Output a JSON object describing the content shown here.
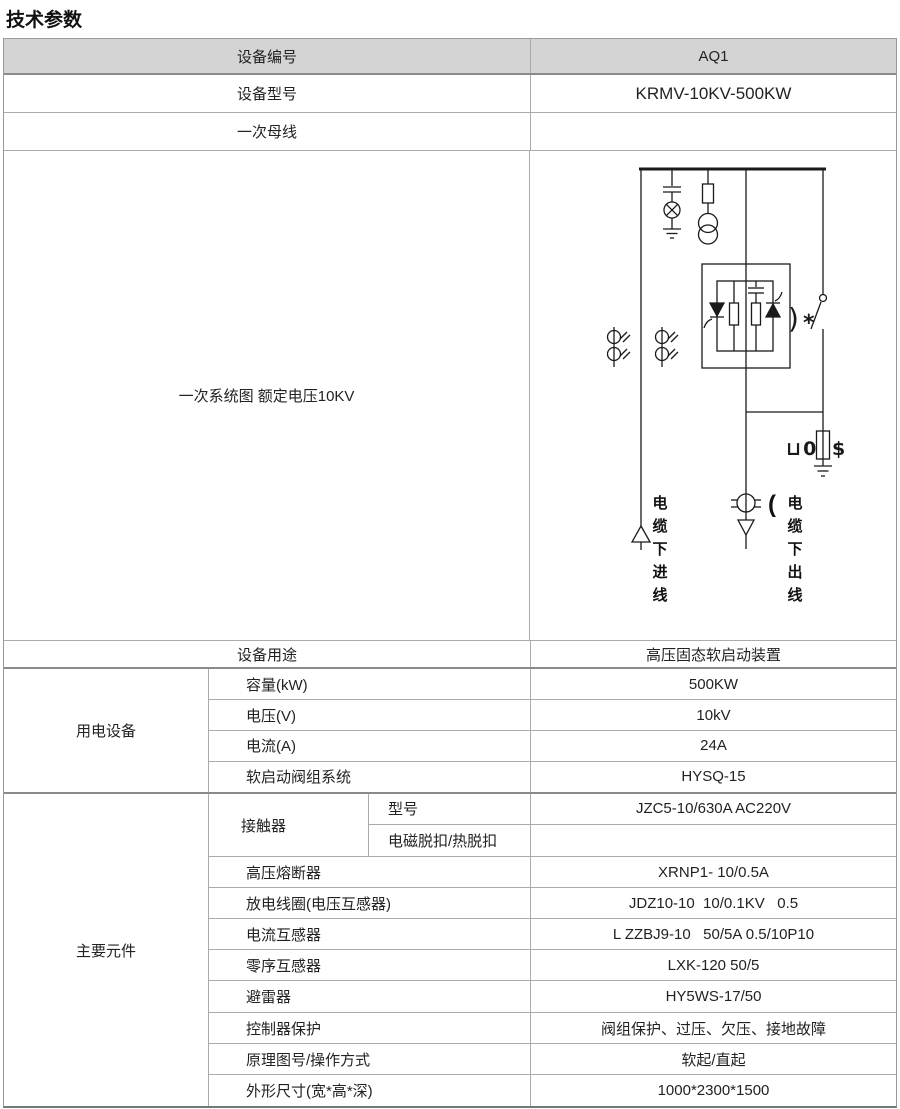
{
  "title": "技术参数",
  "header": {
    "label": "设备编号",
    "value": "AQ1"
  },
  "info_rows": [
    {
      "label": "设备型号",
      "value": "KRMV-10KV-500KW"
    },
    {
      "label": "一次母线",
      "value": ""
    }
  ],
  "diagram_row": {
    "label": "一次系统图 额定电压10KV",
    "incoming_cable": "电缆下进线",
    "outgoing_prefix": "(",
    "outgoing_cable": "电缆下出线",
    "switch_paren": ")",
    "switch_star": "*",
    "arrester_left": "⊔0",
    "arrester_right": "$"
  },
  "purpose_row": {
    "label": "设备用途",
    "value": "高压固态软启动装置"
  },
  "power_group": {
    "label": "用电设备",
    "rows": [
      {
        "label": "容量(kW)",
        "value": "500KW"
      },
      {
        "label": "电压(V)",
        "value": "10kV"
      },
      {
        "label": "电流(A)",
        "value": "24A"
      },
      {
        "label": "软启动阀组系统",
        "value": "HYSQ-15"
      }
    ]
  },
  "components_group": {
    "label": "主要元件",
    "contactor": {
      "label": "接触器",
      "rows": [
        {
          "label": "型号",
          "value": "JZC5-10/630A AC220V"
        },
        {
          "label": "电磁脱扣/热脱扣",
          "value": ""
        }
      ]
    },
    "rows": [
      {
        "label": "高压熔断器",
        "value": "XRNP1- 10/0.5A"
      },
      {
        "label": "放电线圈(电压互感器)",
        "value": "JDZ10-10  10/0.1KV   0.5"
      },
      {
        "label": "电流互感器",
        "value": "L ZZBJ9-10   50/5A 0.5/10P10"
      },
      {
        "label": "零序互感器",
        "value": "LXK-120 50/5"
      },
      {
        "label": "避雷器",
        "value": "HY5WS-17/50"
      },
      {
        "label": "控制器保护",
        "value": "阀组保护、过压、欠压、接地故障"
      },
      {
        "label": "原理图号/操作方式",
        "value": "软起/直起"
      },
      {
        "label": "外形尺寸(宽*高*深)",
        "value": "1000*2300*1500"
      }
    ]
  },
  "colors": {
    "header_bg": "#d4d4d4",
    "border": "#ababab",
    "border_dark": "#777777",
    "text": "#222222",
    "diagram_line": "#1a1a1a"
  }
}
